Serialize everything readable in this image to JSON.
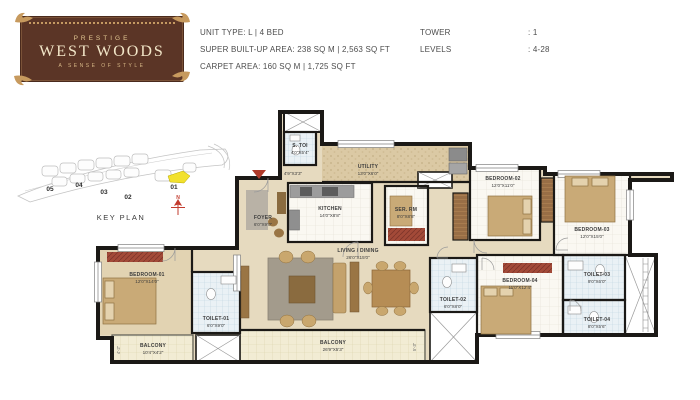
{
  "logo": {
    "brand": "PRESTIGE",
    "name": "WEST WOODS",
    "tagline": "A SENSE OF STYLE"
  },
  "header": {
    "unit_type": "UNIT TYPE: L | 4 BED",
    "super_area": "SUPER BUILT-UP AREA: 238 SQ M | 2,563 SQ FT",
    "carpet_area": "CARPET AREA: 160 SQ M | 1,725 SQ FT",
    "tower_label": "TOWER",
    "tower_value": ": 1",
    "levels_label": "LEVELS",
    "levels_value": ": 4-28"
  },
  "key_plan": {
    "title": "KEY PLAN",
    "towers": [
      "05",
      "04",
      "03",
      "02",
      "01"
    ],
    "highlighted_tower": "01",
    "compass": "N"
  },
  "rooms": {
    "s_toi": {
      "name": "S. TOI",
      "dims": "4'0\"X5'4\""
    },
    "passage": {
      "dims": "4'9\"X3'3\""
    },
    "utility": {
      "name": "UTILITY",
      "dims": "13'0\"X6'0\""
    },
    "foyer": {
      "name": "FOYER",
      "dims": "6'0\"X9'0\""
    },
    "kitchen": {
      "name": "KITCHEN",
      "dims": "14'0\"X8'8\""
    },
    "ser_rm": {
      "name": "SER. RM",
      "dims": "8'0\"X8'8\""
    },
    "bedroom_02": {
      "name": "BEDROOM-02",
      "dims": "12'0\"X11'0\""
    },
    "bedroom_03": {
      "name": "BEDROOM-03",
      "dims": "12'0\"X15'0\""
    },
    "living_dining": {
      "name": "LIVING / DINING",
      "dims": "26'0\"X15'0\""
    },
    "bedroom_01": {
      "name": "BEDROOM-01",
      "dims": "12'0\"X14'0\""
    },
    "toilet_01": {
      "name": "TOILET-01",
      "dims": "6'0\"X9'0\""
    },
    "balcony_small": {
      "name": "BALCONY",
      "dims": "10'4\"X4'2\"",
      "side": "4'-2\""
    },
    "balcony_large": {
      "name": "BALCONY",
      "dims": "26'9\"X5'3\"",
      "side": "5'-3\""
    },
    "toilet_02": {
      "name": "TOILET-02",
      "dims": "6'0\"X8'0\""
    },
    "bedroom_04": {
      "name": "BEDROOM-04",
      "dims": "11'0\"X12'4\""
    },
    "toilet_03": {
      "name": "TOILET-03",
      "dims": "9'0\"X6'0\""
    },
    "toilet_04": {
      "name": "TOILET-04",
      "dims": "8'0\"X5'6\""
    }
  },
  "colors": {
    "logo_brown": "#5b3526",
    "logo_gold": "#c59a62",
    "wall": "#1b1916",
    "floor_beige": "#e6dabf",
    "tile_blue": "#eaf1f5",
    "balcony_yellow": "#f2ecd4",
    "highlight_yellow": "#f2e12e",
    "entry_red": "#b03a2a"
  }
}
